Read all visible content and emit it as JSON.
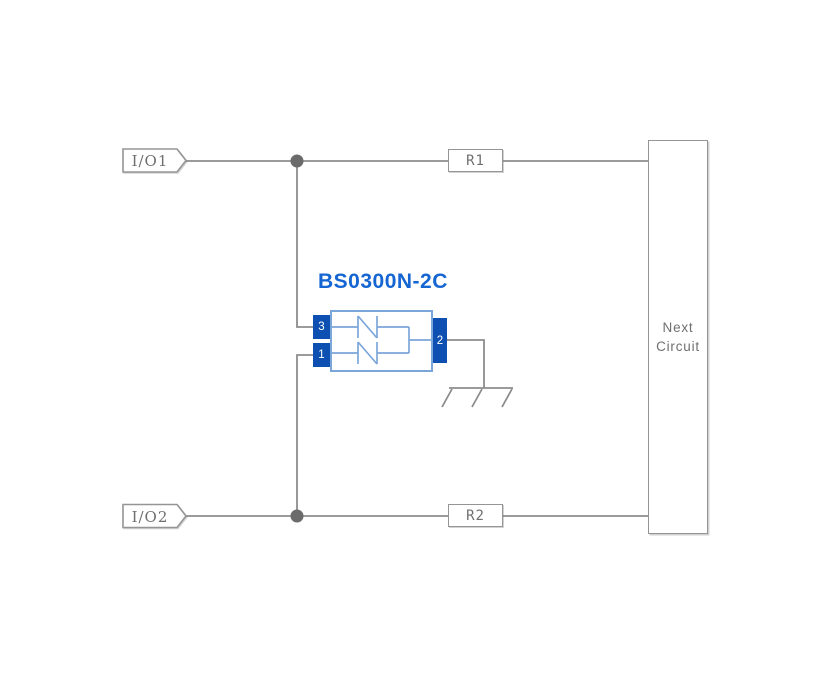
{
  "colors": {
    "background": "#ffffff",
    "wire": "#8d8d8d",
    "junction_dot": "#6b6b6b",
    "outline": "#959595",
    "label_text": "#6f6f6f",
    "component_title": "#1565d2",
    "component_outline": "#7ba6da",
    "pin_fill": "#0d50b2",
    "pin_text": "#ffffff"
  },
  "terminals": {
    "io1": "I/O1",
    "io2": "I/O2"
  },
  "resistors": {
    "r1": "R1",
    "r2": "R2"
  },
  "component": {
    "title": "BS0300N-2C",
    "pin_top_left": "3",
    "pin_bottom_left": "1",
    "pin_right": "2"
  },
  "next_circuit": {
    "line1": "Next",
    "line2": "Circuit"
  }
}
